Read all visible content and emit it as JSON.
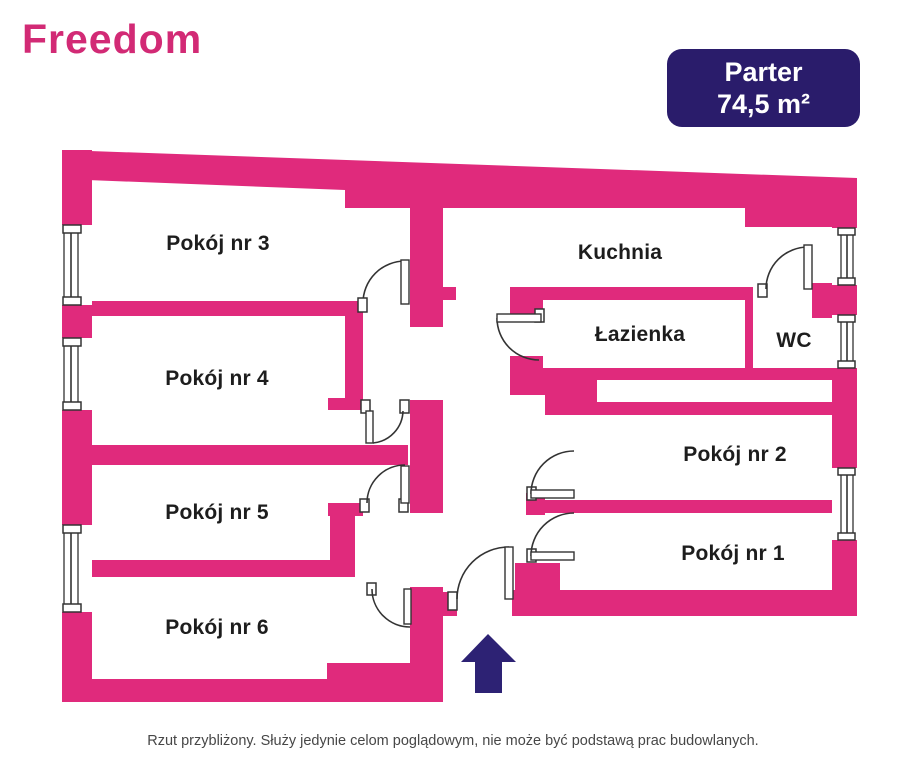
{
  "logo": {
    "text": "Freedom"
  },
  "badge": {
    "title": "Parter",
    "area": "74,5 m²"
  },
  "rooms": {
    "pokoj3": "Pokój nr 3",
    "pokoj4": "Pokój nr 4",
    "pokoj5": "Pokój nr 5",
    "pokoj6": "Pokój nr 6",
    "kuchnia": "Kuchnia",
    "lazienka": "Łazienka",
    "wc": "WC",
    "pokoj2": "Pokój nr 2",
    "pokoj1": "Pokój nr 1"
  },
  "footer": {
    "disclaimer": "Rzut przybliżony. Służy jedynie celom poglądowym, nie może być podstawą prac budowlanych."
  },
  "colors": {
    "wall": "#e02a7c",
    "badge_bg": "#2a1c6b",
    "arrow": "#2d2274",
    "logo": "#d22a75",
    "door_stroke": "#333333"
  }
}
